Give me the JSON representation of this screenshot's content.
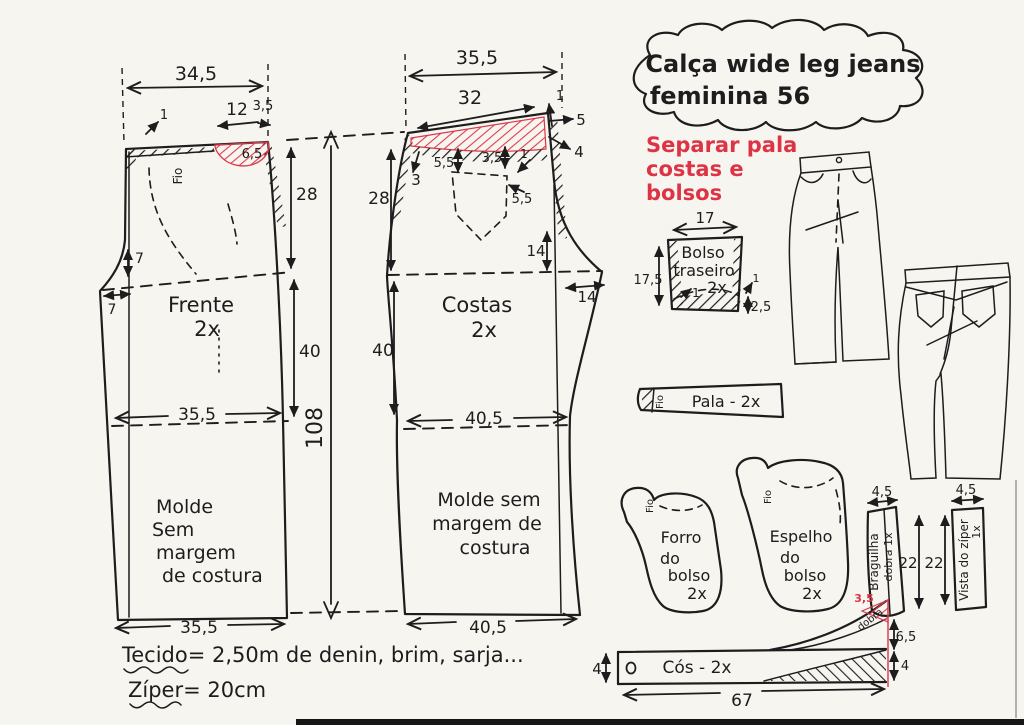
{
  "title": {
    "line1": "Calça wide leg jeans",
    "line2": "feminina 56"
  },
  "red_note": {
    "l1": "Separar pala",
    "l2": "costas e",
    "l3": "bolsos"
  },
  "total_length": "108",
  "frente": {
    "name": "Frente",
    "qty": "2x",
    "grain": "Fio",
    "top_width": "34,5",
    "m1": "1",
    "pocket_opening": "12",
    "m35": "3,5",
    "pocket_depth": "6,5",
    "rise": "28",
    "seven_v": "7",
    "seven_h": "7",
    "length": "40",
    "knee_width": "35,5",
    "molde1": "Molde",
    "molde2": "Sem",
    "molde3": "margem",
    "molde4": "de costura",
    "hem_width": "35,5"
  },
  "costas": {
    "name": "Costas",
    "qty": "2x",
    "top_width": "35,5",
    "yoke_width": "32",
    "m1_top": "1",
    "m5": "5",
    "m4": "4",
    "m3": "3",
    "yoke_left": "5,5",
    "yoke_right": "3,5",
    "m1_mid": "1",
    "pocket_pos": "5,5",
    "rise": "28",
    "length": "40",
    "back_v": "14",
    "crotch_ext": "14",
    "knee_width": "40,5",
    "molde1": "Molde sem",
    "molde2": "margem de",
    "molde3": "costura",
    "hem_width": "40,5"
  },
  "bolso": {
    "l1": "Bolso",
    "l2": "traseiro",
    "l3": "2x",
    "width": "17",
    "height": "17,5",
    "m1": "1",
    "m1b": "1",
    "hem": "2,5"
  },
  "pala": {
    "label": "Pala - 2x",
    "grain": "Fio"
  },
  "forro": {
    "l1": "Forro",
    "l2": "do",
    "l3": "bolso",
    "l4": "2x",
    "grain": "Fio"
  },
  "espelho": {
    "l1": "Espelho",
    "l2": "do",
    "l3": "bolso",
    "l4": "2x",
    "grain": "Fio"
  },
  "braguilha": {
    "label": "Braguilha",
    "fold": "dobra 1x",
    "width": "4,5",
    "height": "22"
  },
  "vista": {
    "label": "Vista do zíper",
    "qty": "1x",
    "width": "4,5",
    "height": "22"
  },
  "cos": {
    "label": "Cós - 2x",
    "height_left": "4",
    "length": "67",
    "ext": "6,5",
    "band": "4",
    "fold": "3,5",
    "fold_word": "dobra"
  },
  "notes": {
    "fabric": "Tecido= 2,50m de denin, brim, sarja...",
    "zipper": "Zíper= 20cm"
  }
}
